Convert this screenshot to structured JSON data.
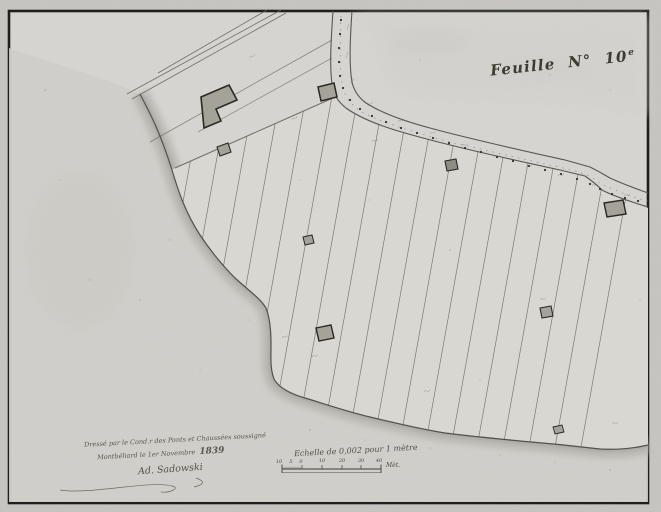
{
  "sheet": {
    "title": {
      "word": "Feuille",
      "no_label": "N°",
      "number": "10",
      "exponent": "e"
    },
    "attribution": {
      "line1": "Dressé par le Cond.r des Ponts et Chaussées soussigné",
      "line2_place_date": "Montbéliard le 1er Novembre",
      "line2_year": "1839",
      "signature": "Ad. Sadowski"
    },
    "scale": {
      "caption": "Echelle de 0,002 pour 1 mètre",
      "unit_label": "Mèt.",
      "sub_labels": [
        "10",
        "5",
        "0"
      ],
      "major_labels": [
        "10",
        "20",
        "30",
        "40"
      ]
    },
    "colors": {
      "paper": "#d7d6d2",
      "water_wash": "#b3b2ac",
      "ink": "#55534e",
      "frame": "#1b1b19",
      "building_fill": "#a5a29a"
    }
  }
}
